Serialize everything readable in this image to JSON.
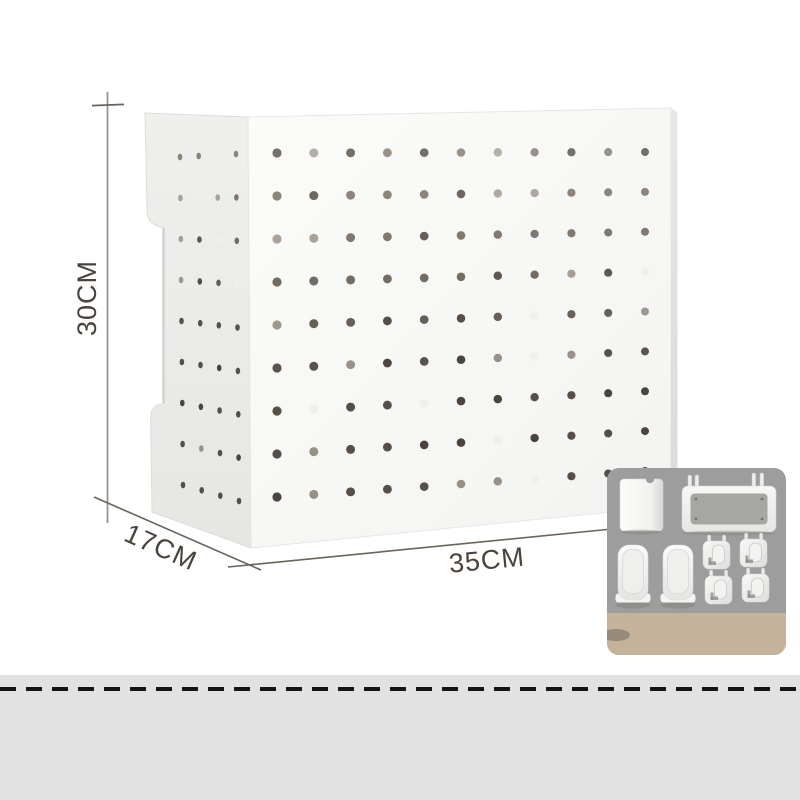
{
  "labels": {
    "height": "30CM",
    "depth": "17CM",
    "width": "35CM"
  },
  "colors": {
    "background": "#ffffff",
    "front_face": "#f9f9f7",
    "side_face": "#ececea",
    "right_edge": "#e0e0de",
    "dimension_line": "#6b645c",
    "guide_line": "#9a948d",
    "dimension_text": "#4a433c",
    "hole_top": "#9a9288",
    "hole_bottom": "#564f47",
    "hole_light": "#f2efe9",
    "inset_bg": "#9d9d9d",
    "inset_strip": "#c4b29b",
    "accessory_white": "#f2f2f0",
    "bottom_band": "#e2e2e2",
    "stitch_dash": "#141414"
  },
  "front_holes": {
    "rows": 9,
    "cols": 11
  },
  "side_holes": {
    "rows": 9,
    "cols": 4
  },
  "inset_accessories": {
    "cup": "storage-cup",
    "tray": "wall-mount-tray",
    "long_trays": [
      "long-tray",
      "long-tray"
    ],
    "hooks": [
      "peg-hook",
      "peg-hook",
      "peg-hook",
      "peg-hook"
    ]
  }
}
